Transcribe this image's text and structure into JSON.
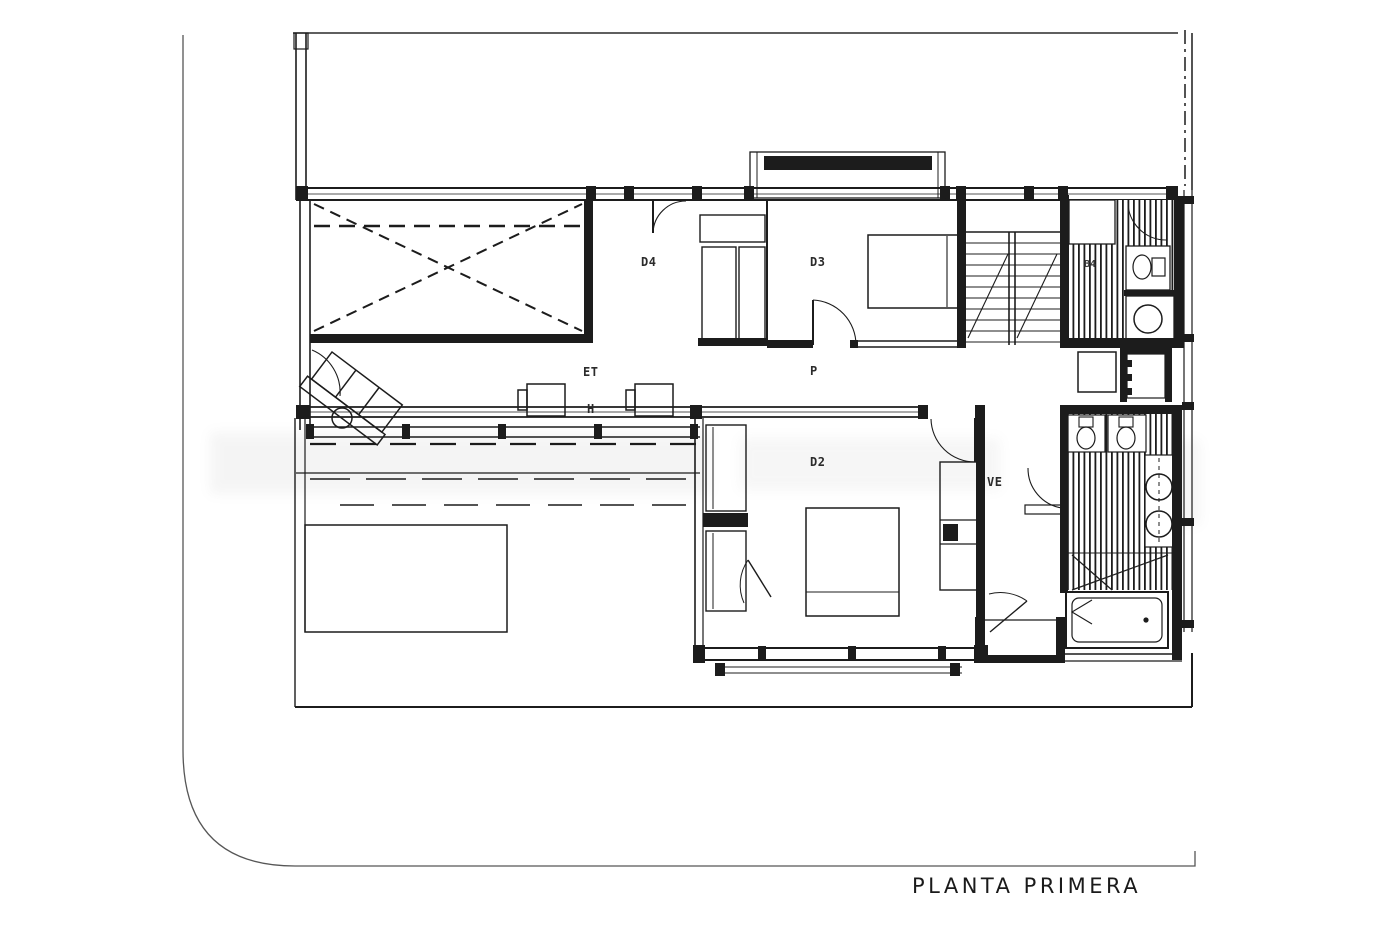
{
  "colors": {
    "background": "#ffffff",
    "line": "#1c1c1c",
    "boundary": "#565656"
  },
  "plan": {
    "title": "PLANTA  PRIMERA",
    "labels": {
      "room_d4": "D4",
      "room_d3": "D3",
      "room_d2": "D2",
      "corridor_et": "ET",
      "corridor_h": "H",
      "corridor_p": "P",
      "vestibule": "VE",
      "bath_upper": "B4"
    }
  }
}
